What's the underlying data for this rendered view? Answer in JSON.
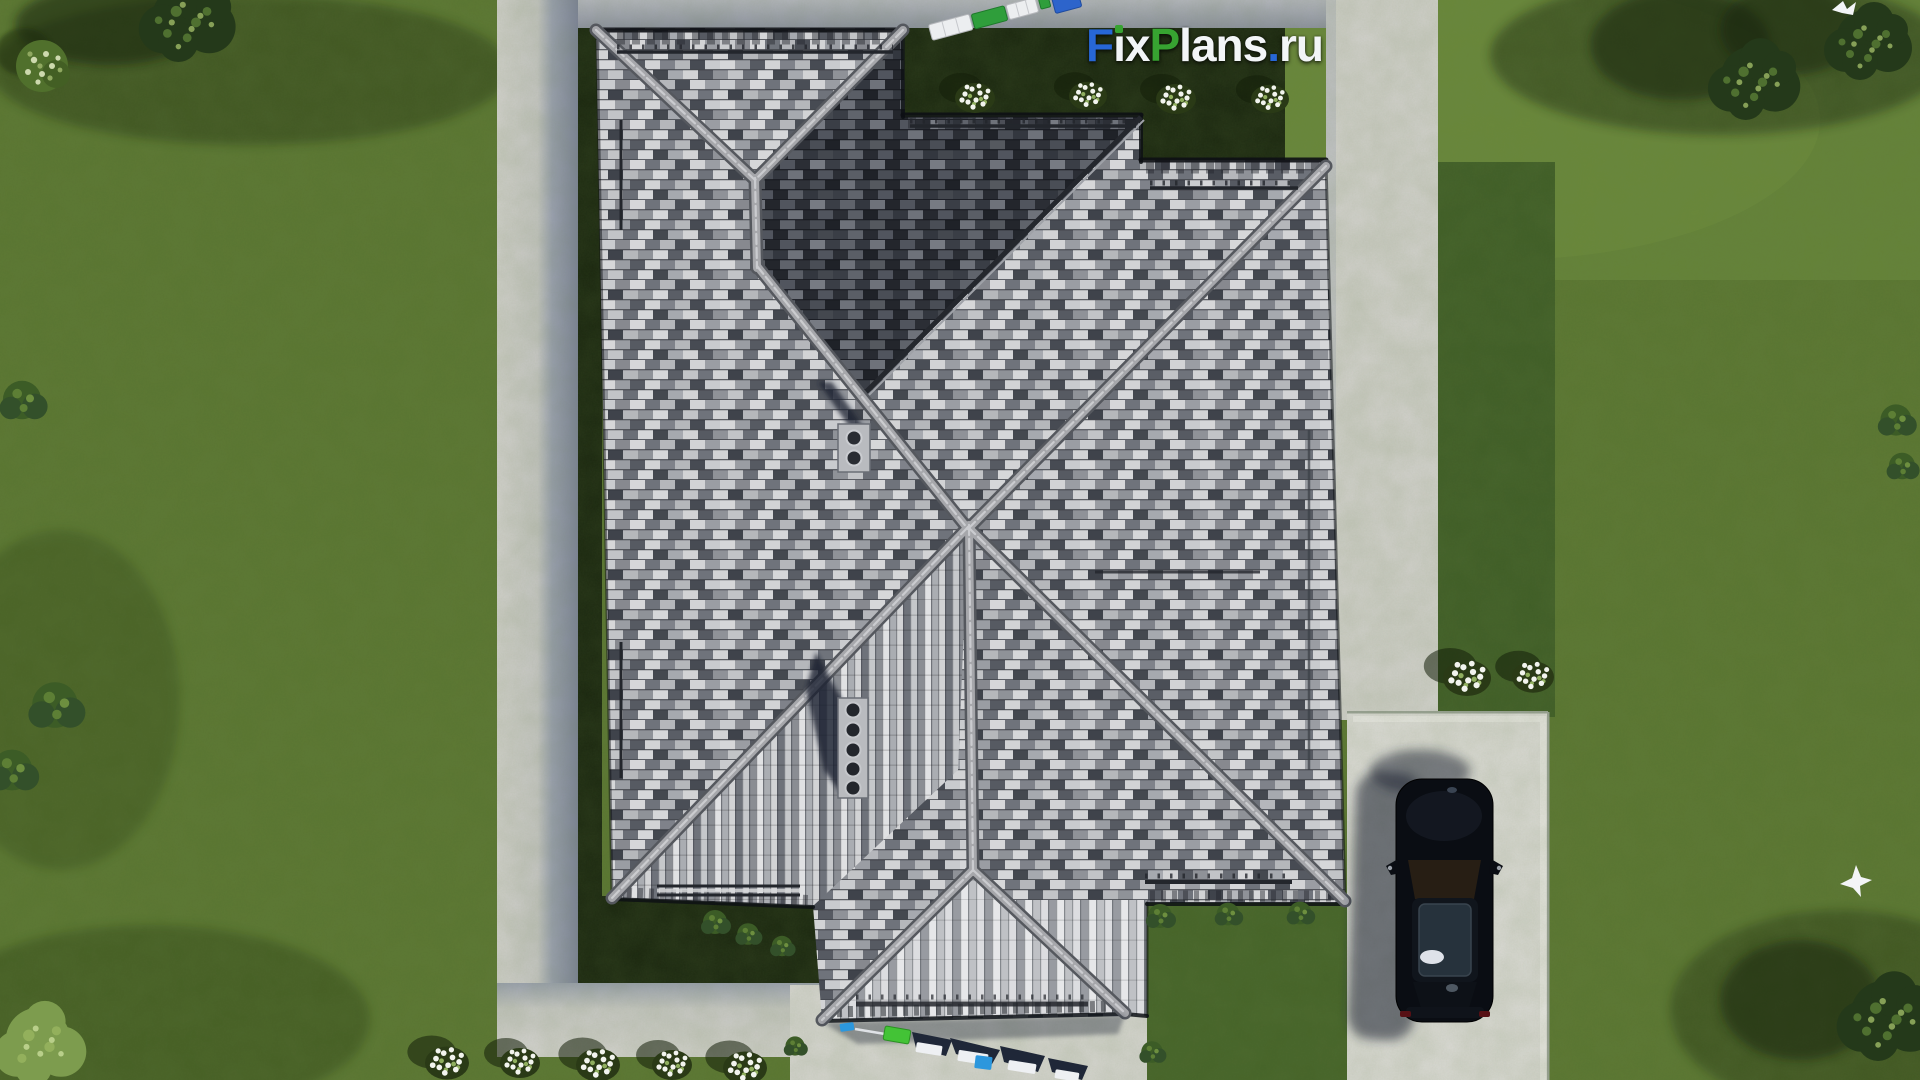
{
  "watermark": {
    "text": "FixPlans.ru",
    "seg_f": "F",
    "seg_i_stem": "ı",
    "seg_x": "x",
    "seg_p": "P",
    "seg_lans": "lans",
    "seg_dot": ".",
    "seg_ru": "ru"
  },
  "colors": {
    "logo_blue": "#2767d6",
    "logo_green": "#37a331",
    "logo_white": "#f2f5f7",
    "grass_base": "#5a7631",
    "grass_light": "#7fa04a",
    "lawn_dark": "#3f5d26",
    "garden_bed": "#1a260f",
    "concrete_lit": "#d6d5d1",
    "concrete_shadow": "#7d8398",
    "path_top": "#a6a9b4",
    "roof_ridge": "#a6a7ab",
    "car_body": "#0a0d13",
    "car_glass": "#26323c",
    "bin_green": "#2f9e3b",
    "bin_blue": "#2d64cb",
    "furn_green": "#43c336",
    "furn_blue": "#2c97dd",
    "flower_white": "#f2f4ee",
    "tree_dark": "#24391a",
    "tree_light": "#7d9c4e",
    "bird_white": "#f3f5f7"
  }
}
